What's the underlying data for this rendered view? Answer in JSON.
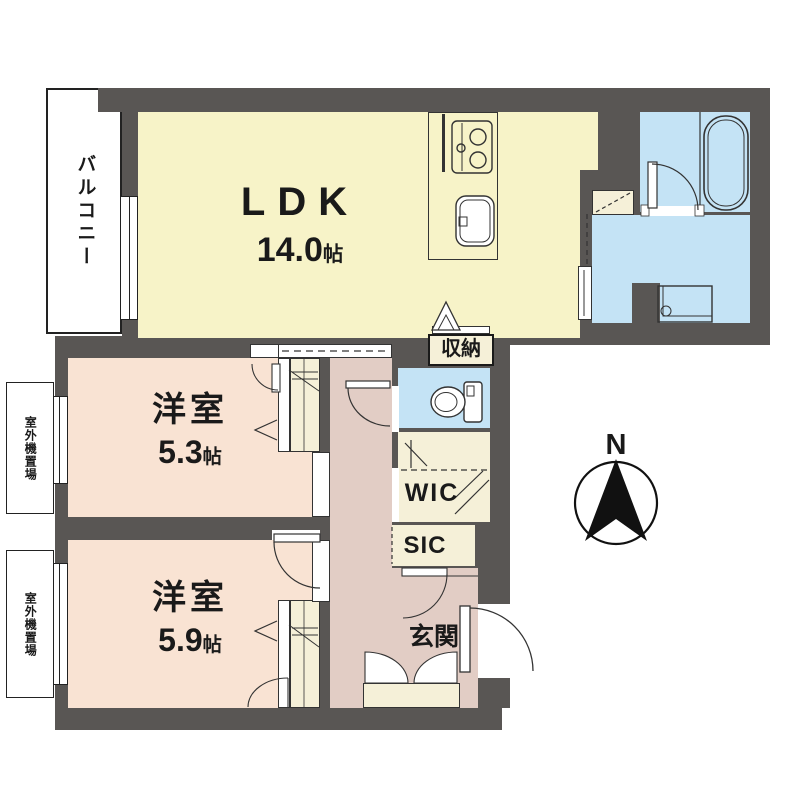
{
  "colors": {
    "wall": "#595654",
    "ldk": "#F7F3C8",
    "bedroom": "#F9E3D3",
    "hall": "#E2CDC5",
    "wet": "#C4E3F5",
    "closet": "#F5F0D8"
  },
  "rooms": {
    "ldk": {
      "label": "LDK",
      "area": "14.0",
      "unit": "帖"
    },
    "bedroom1": {
      "label": "洋室",
      "area": "5.3",
      "unit": "帖"
    },
    "bedroom2": {
      "label": "洋室",
      "area": "5.9",
      "unit": "帖"
    },
    "balcony": {
      "label": "バルコニー"
    },
    "storage": {
      "label": "収納"
    },
    "wic": {
      "label": "WIC"
    },
    "sic": {
      "label": "SIC"
    },
    "entrance": {
      "label": "玄関"
    },
    "outdoor_unit1": {
      "label": "室外機置場"
    },
    "outdoor_unit2": {
      "label": "室外機置場"
    }
  },
  "compass": {
    "label": "N"
  },
  "icons": [
    "compass-icon",
    "stove-icon",
    "sink-icon",
    "bathtub-icon",
    "toilet-icon",
    "washing-machine-icon",
    "door-swing-icon",
    "folding-door-icon",
    "hanger-pipe-icon",
    "sliding-door-icon"
  ]
}
